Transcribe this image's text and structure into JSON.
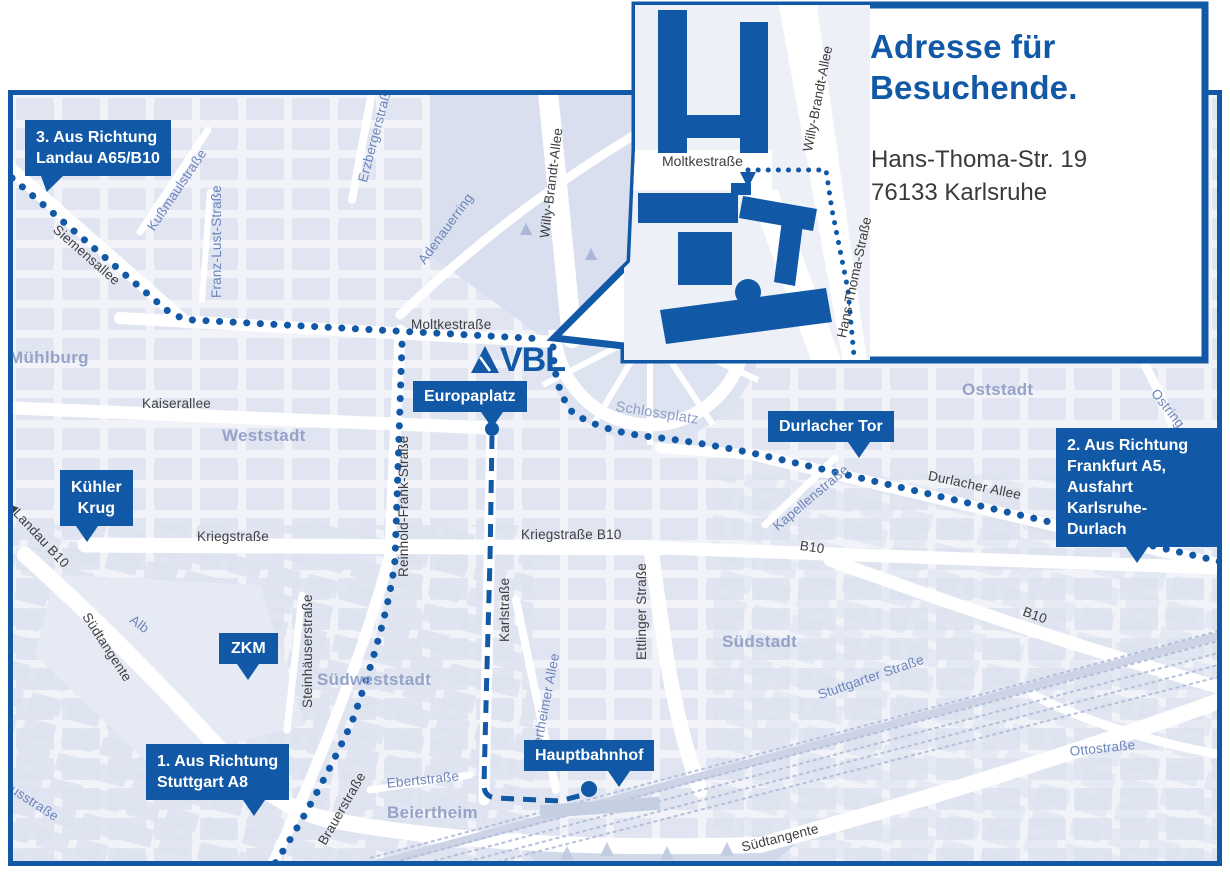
{
  "colors": {
    "accent": "#1158a6",
    "map_background": "#f1f3f9",
    "block_fill": "#dde3f0",
    "street_label": "#3f3f3f",
    "blue_street_label": "#6d85bb",
    "district_label": "#95a3c8"
  },
  "inset": {
    "title": "Adresse für\nBesuchende.",
    "address": "Hans-Thoma-Str. 19\n76133 Karlsruhe",
    "streets": {
      "moltkestrasse": "Moltkestraße",
      "willy_brandt_allee": "Willy-Brandt-Allee",
      "hans_thoma_strasse": "Hans-Thoma-Straße"
    }
  },
  "logo": {
    "text": "VBL"
  },
  "badges": {
    "landau": "3. Aus Richtung\nLandau A65/B10",
    "frankfurt": "2. Aus Richtung\nFrankfurt A5,\nAusfahrt\nKarlsruhe-Durlach",
    "stuttgart": "1. Aus Richtung\nStuttgart A8",
    "kuehler_krug": "Kühler\nKrug",
    "zkm": "ZKM",
    "europaplatz": "Europaplatz",
    "durlacher_tor": "Durlacher Tor",
    "hauptbahnhof": "Hauptbahnhof"
  },
  "streets": {
    "siemensallee": "Siemensallee",
    "moltkestrasse": "Moltkestraße",
    "kaiserallee": "Kaiserallee",
    "kriegstrasse": "Kriegstraße",
    "kriegstrasse_b10": "Kriegstraße B10",
    "landau_b10_arrow": "◀",
    "landau_b10": "Landau B10",
    "b10_east": "B10",
    "b10_southeast": "B10",
    "durlacher_allee": "Durlacher Allee",
    "suedtangente_west": "Südtangente",
    "suedtangente_south": "Südtangente",
    "karlstrasse": "Karlstraße",
    "ettlinger_strasse": "Ettlinger Straße",
    "reinhold_frank_strasse": "Reinhold-Frank-Straße",
    "steinhaeuserstrasse": "Steinhäuserstraße",
    "brauerstrasse": "Brauerstraße",
    "erzbergerstrasse": "Erzbergerstraße",
    "kussmaulstrasse": "Kußmaulstraße",
    "franz_lust_strasse": "Franz-Lust-Straße",
    "willy_brandt_allee": "Willy-Brandt-Allee",
    "adenauerring": "Adenauerring",
    "kapellenstrasse": "Kapellenstraße",
    "ostring_north": "Ostring",
    "ostring_south": "Ostring",
    "stuttgarter_strasse": "Stuttgarter Straße",
    "ottostrasse": "Ottostraße",
    "ebertstrasse": "Ebertstraße",
    "beiertheimer_allee": "Beiertheimer Allee",
    "alb": "Alb",
    "pulverhausstrasse": "Pulverhausstraße",
    "schlossplatz": "Schlossplatz"
  },
  "districts": {
    "muehlburg": "Mühlburg",
    "weststadt": "Weststadt",
    "oststadt": "Oststadt",
    "suedstadt": "Südstadt",
    "suedweststadt": "Südweststadt",
    "beiertheim": "Beiertheim"
  }
}
